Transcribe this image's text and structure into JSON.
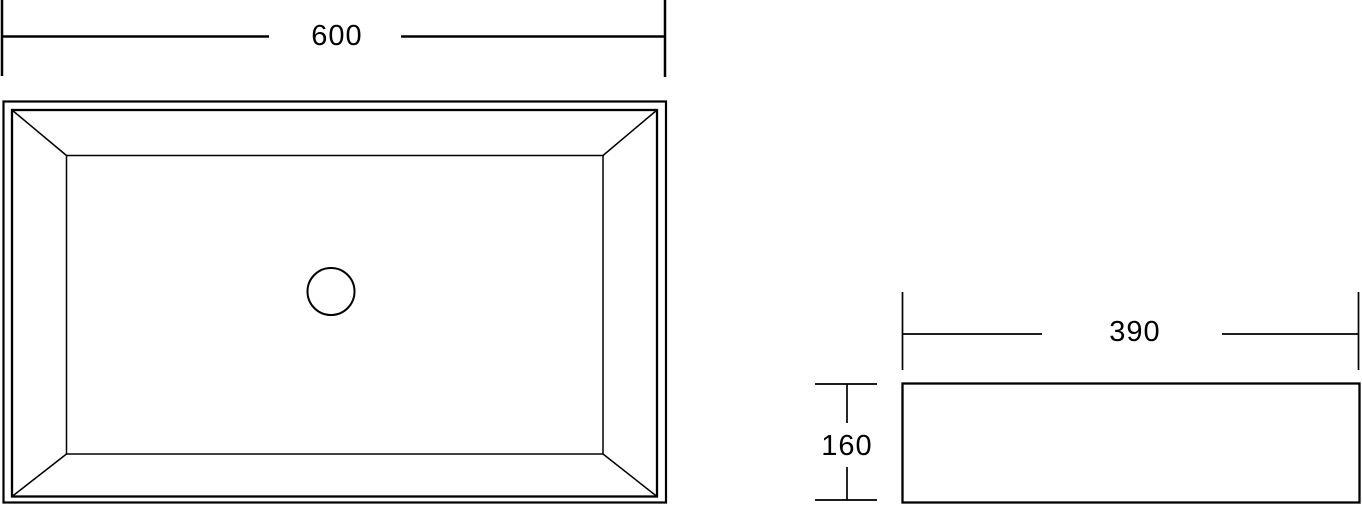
{
  "page": {
    "background": "#ffffff",
    "line_color": "#000000",
    "description_labels_visible": [
      "600",
      "390",
      "160"
    ]
  },
  "top_view": {
    "width_dimension_label": "600"
  },
  "side_view": {
    "width_dimension_label": "390",
    "height_dimension_label": "160"
  }
}
